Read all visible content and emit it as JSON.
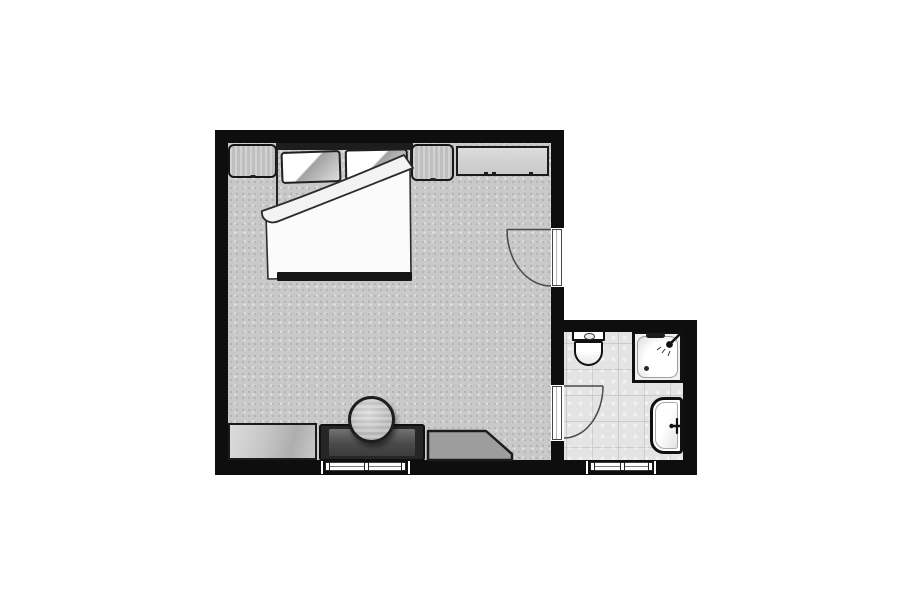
{
  "plan": {
    "type": "floor-plan",
    "background_color": "#ffffff",
    "wall_color": "#0e0e0e",
    "bedroom": {
      "label": "bedroom",
      "floor_color": "#c9c9c9",
      "floor_texture": "speckled-carpet",
      "furniture": [
        "double-bed",
        "pillow-left",
        "pillow-right",
        "headboard",
        "nightstand-left",
        "nightstand-right",
        "dresser",
        "low-cabinet",
        "vanity-desk",
        "round-stool",
        "corner-bench"
      ]
    },
    "bathroom": {
      "label": "bathroom",
      "floor_color": "#e4e4e4",
      "floor_texture": "tile",
      "fixtures": [
        "toilet",
        "shower",
        "washbasin"
      ]
    },
    "doors": [
      {
        "label": "bedroom-entry-door",
        "wall": "right",
        "swing": "into-bedroom"
      },
      {
        "label": "bathroom-door",
        "wall": "bedroom-bathroom-partition",
        "swing": "into-bathroom"
      }
    ],
    "windows": [
      {
        "label": "bedroom-window",
        "wall": "bottom"
      },
      {
        "label": "bathroom-window",
        "wall": "bottom"
      }
    ]
  }
}
